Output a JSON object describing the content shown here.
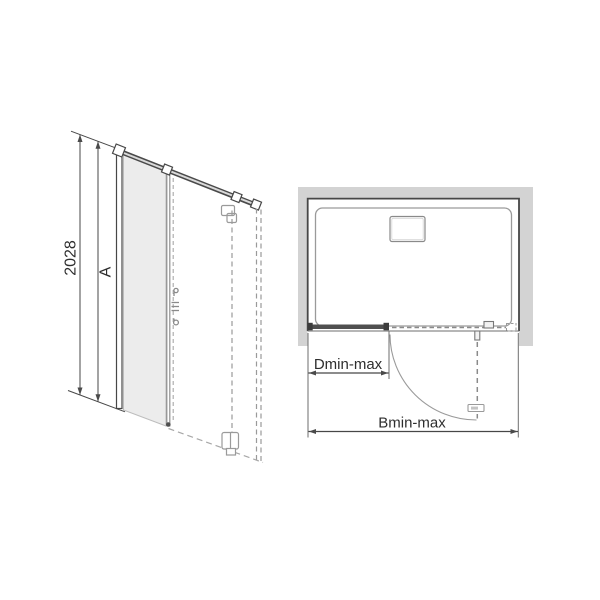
{
  "page": {
    "background": "#ffffff"
  },
  "colors": {
    "wall_fill": "#d3d3d3",
    "glass_fill": "#ececec",
    "panel_bar": "#4f4f4f",
    "panel_block": "#3c3c3c",
    "dark_line": "#474747",
    "gray_line": "#9a9a9a",
    "text": "#2e2e2e"
  },
  "front_view": {
    "overall_height_label": "2028",
    "glass_height_label": "A"
  },
  "plan_view": {
    "door_width_label": "Dmin-max",
    "total_width_label": "Bmin-max"
  }
}
